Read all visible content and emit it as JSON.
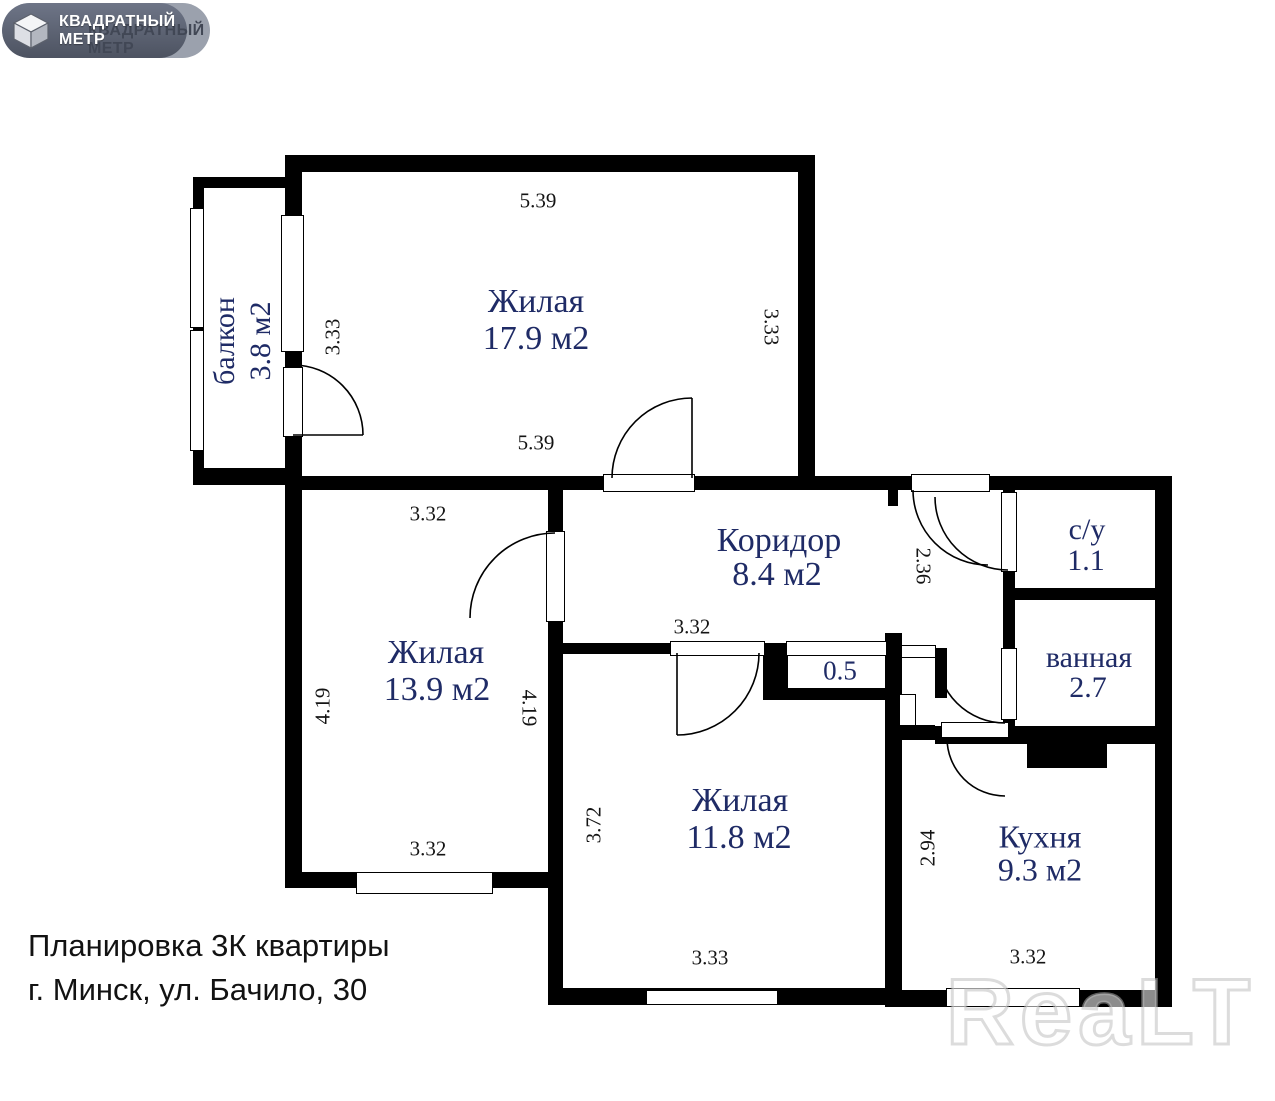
{
  "logo": {
    "brand_line1": "КВАДРАТНЫЙ",
    "brand_line2": "МЕТР"
  },
  "plan": {
    "rooms": {
      "living1": {
        "name": "Жилая",
        "area": "17.9 м2"
      },
      "living2": {
        "name": "Жилая",
        "area": "13.9 м2"
      },
      "living3": {
        "name": "Жилая",
        "area": "11.8 м2"
      },
      "corridor": {
        "name": "Коридор",
        "area": "8.4 м2"
      },
      "kitchen": {
        "name": "Кухня",
        "area": "9.3 м2"
      },
      "wc": {
        "name": "с/у",
        "area": "1.1"
      },
      "bathroom": {
        "name": "ванная",
        "area": "2.7"
      },
      "closet": {
        "area": "0.5"
      },
      "balcony": {
        "name": "балкон",
        "area": "3.8 м2"
      }
    },
    "dimensions": {
      "living1_top": "5.39",
      "living1_left": "3.33",
      "living1_right": "3.33",
      "living1_bottom": "5.39",
      "living2_top": "3.32",
      "living2_left": "4.19",
      "living2_right": "4.19",
      "living2_bottom": "3.32",
      "corridor_bottom": "3.32",
      "hallway_height": "2.36",
      "living3_left": "3.72",
      "living3_bottom": "3.33",
      "kitchen_left": "2.94",
      "kitchen_bottom": "3.32"
    }
  },
  "caption": {
    "line1": "Планировка 3К квартиры",
    "line2": "г. Минск, ул. Бачило, 30"
  },
  "watermark": {
    "text": "ReaLT"
  },
  "colors": {
    "wall": "#000000",
    "room_label": "#1f2b66",
    "dimension_label": "#141414",
    "logo_background": "#4d5361"
  }
}
